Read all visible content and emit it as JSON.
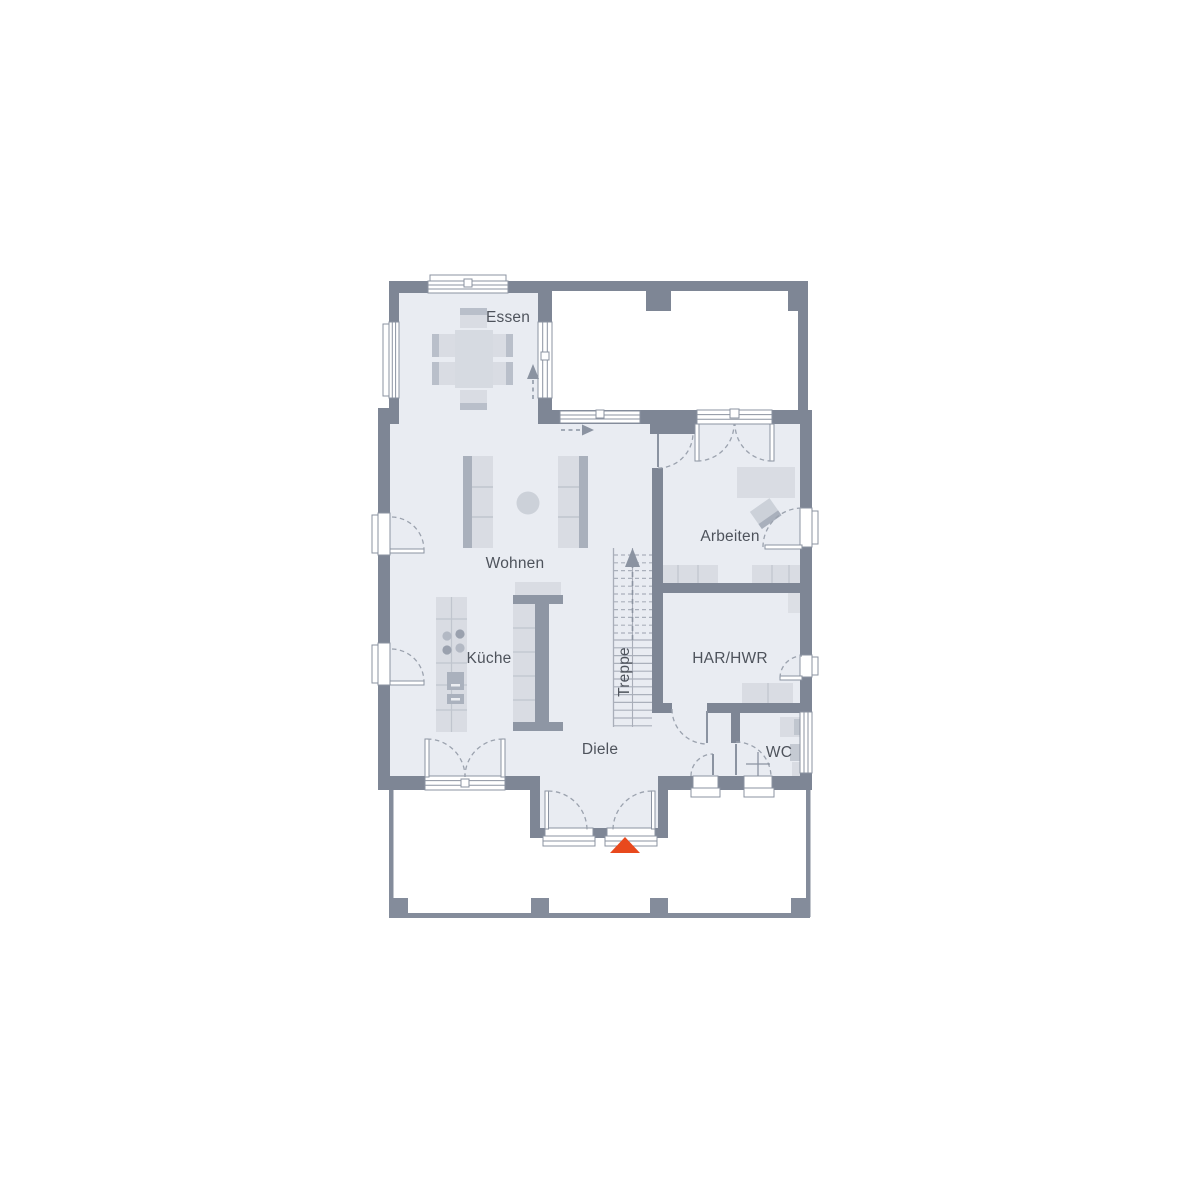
{
  "title": "Erdgeschoss Grundriss (ground-floor plan)",
  "colors": {
    "wall": "#7e8695",
    "floor": "#e9ecf2",
    "furniture_light": "#d9dce3",
    "furniture_mid": "#c5cad3",
    "furniture_dark": "#8e96a4",
    "sofa_strip": "#a9b0bc",
    "outline": "#98a0ac",
    "label_text": "#4e535c",
    "entrance_accent": "#e8491d"
  },
  "rooms": [
    {
      "id": "essen",
      "label": "Essen"
    },
    {
      "id": "wohnen",
      "label": "Wohnen"
    },
    {
      "id": "kueche",
      "label": "Küche"
    },
    {
      "id": "diele",
      "label": "Diele"
    },
    {
      "id": "treppe",
      "label": "Treppe"
    },
    {
      "id": "arbeiten",
      "label": "Arbeiten"
    },
    {
      "id": "har_hwr",
      "label": "HAR/HWR"
    },
    {
      "id": "wc",
      "label": "WC"
    }
  ],
  "markers": {
    "entrance": "entrance-triangle-marker",
    "stair_direction": "stairs-up-arrow",
    "flow_arrows": [
      "essen-terrace-arrow",
      "diele-corridor-arrow"
    ]
  }
}
